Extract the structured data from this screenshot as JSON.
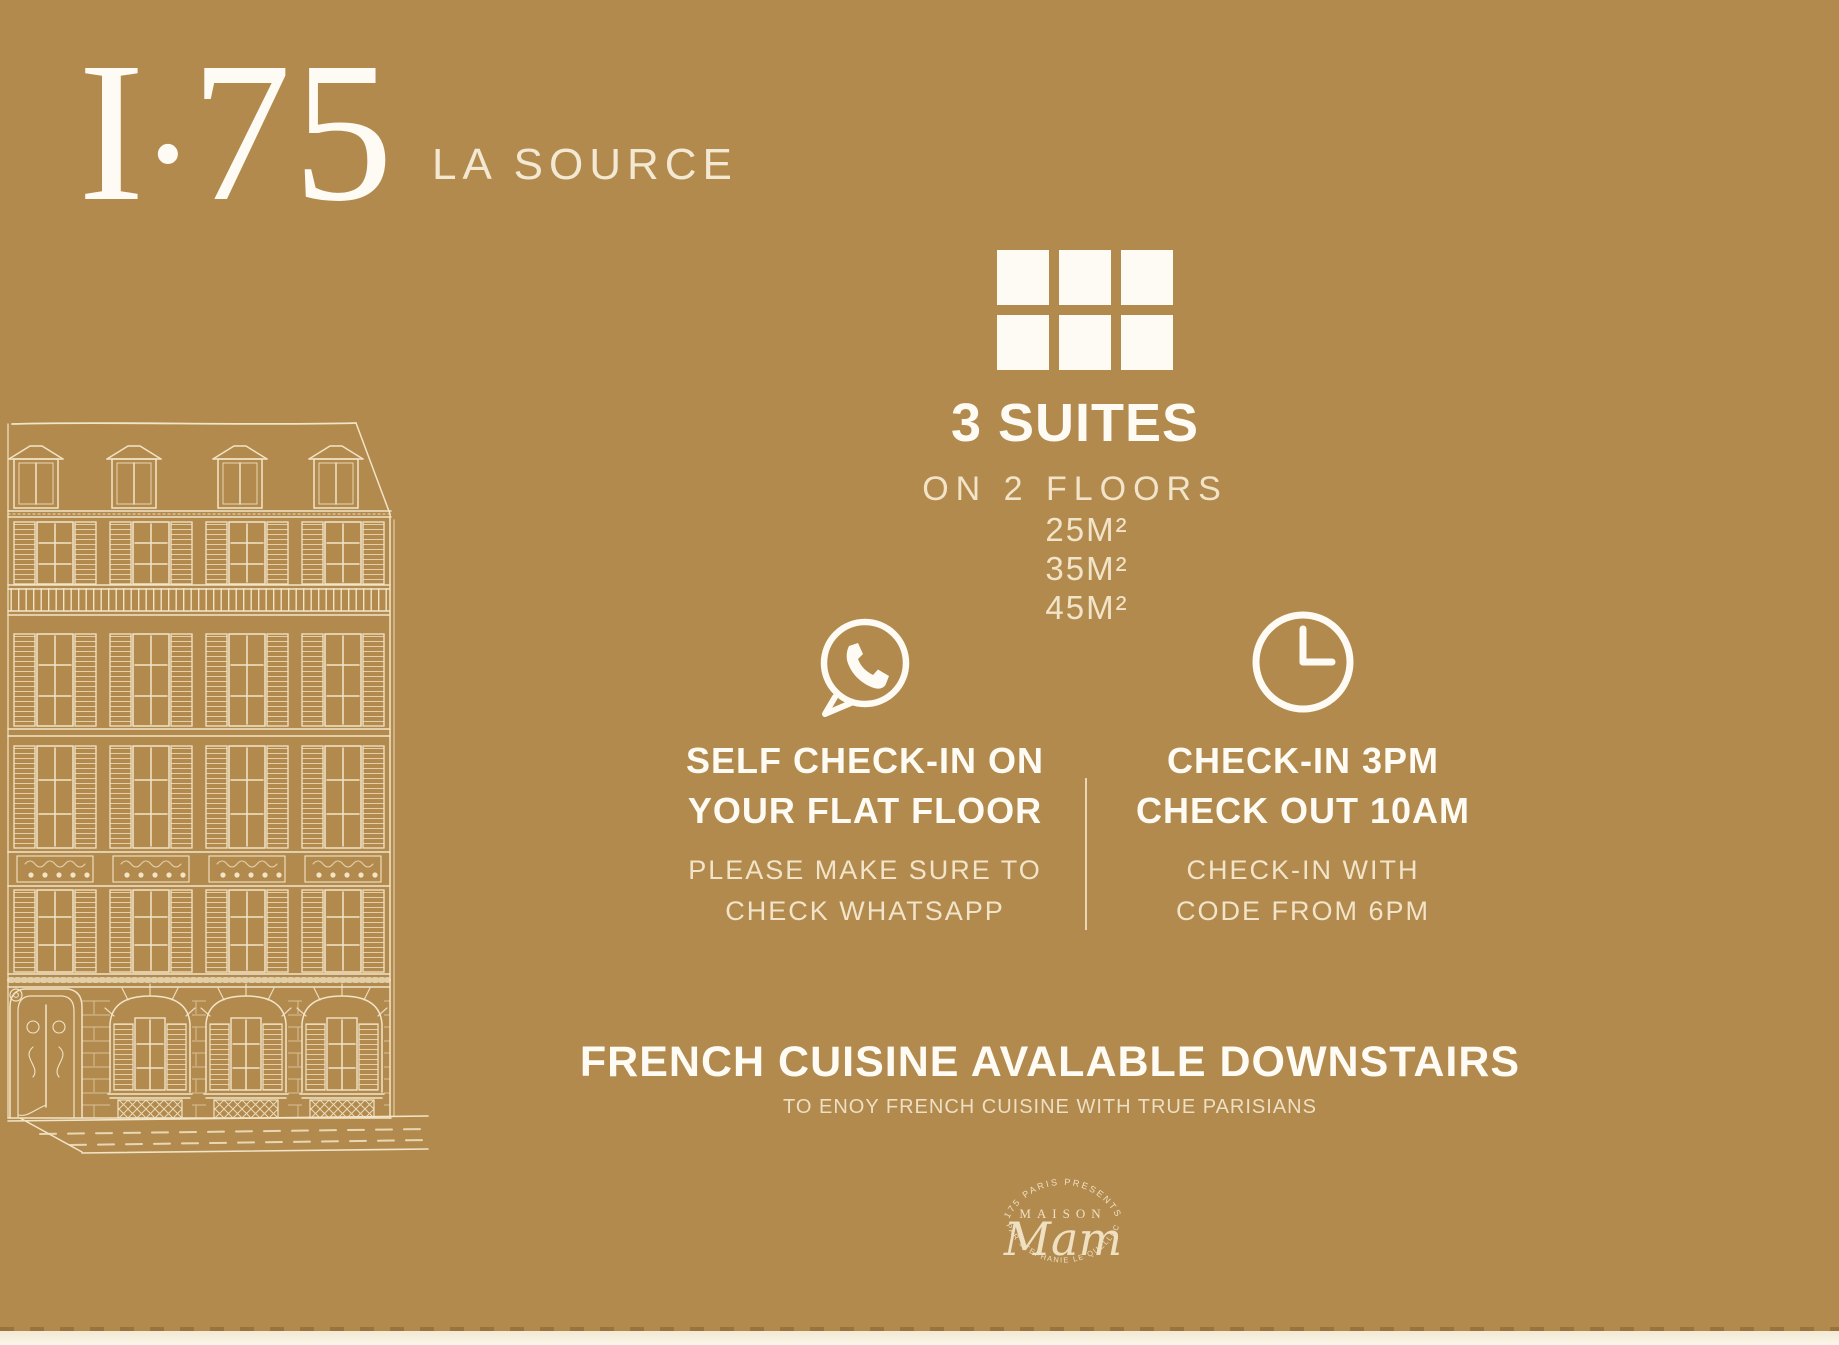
{
  "page": {
    "background_color": "#b28a4e",
    "white_color": "#fdfbf3",
    "cream_color": "#f2e4c8"
  },
  "header": {
    "title": "I.75",
    "title_parts": [
      "I",
      ".",
      "75"
    ],
    "subtitle": "LA SOURCE"
  },
  "suites": {
    "icon": "room-grid-icon",
    "heading": "3 SUITES",
    "subheading": "ON 2 FLOORS",
    "sizes": [
      "25M²",
      "35M²",
      "45M²"
    ]
  },
  "checkin_left": {
    "icon": "whatsapp-icon",
    "title_line1": "SELF CHECK-IN ON",
    "title_line2": "YOUR FLAT FLOOR",
    "note_line1": "PLEASE MAKE SURE TO",
    "note_line2": "CHECK WHATSAPP"
  },
  "checkin_right": {
    "icon": "clock-icon",
    "title_line1": "CHECK-IN 3PM",
    "title_line2": "CHECK OUT 10AM",
    "note_line1": "CHECK-IN WITH",
    "note_line2": "CODE FROM 6PM"
  },
  "dining": {
    "heading": "FRENCH CUISINE AVALABLE DOWNSTAIRS",
    "subheading": "TO ENOY FRENCH CUISINE WITH TRUE PARISIANS"
  },
  "logo": {
    "arc_top": "175 PARIS PRESENTS",
    "name_top": "MAISON",
    "name_script": "Mam",
    "arc_bottom": "PAR STEPHANIE LE QUELLEC"
  }
}
